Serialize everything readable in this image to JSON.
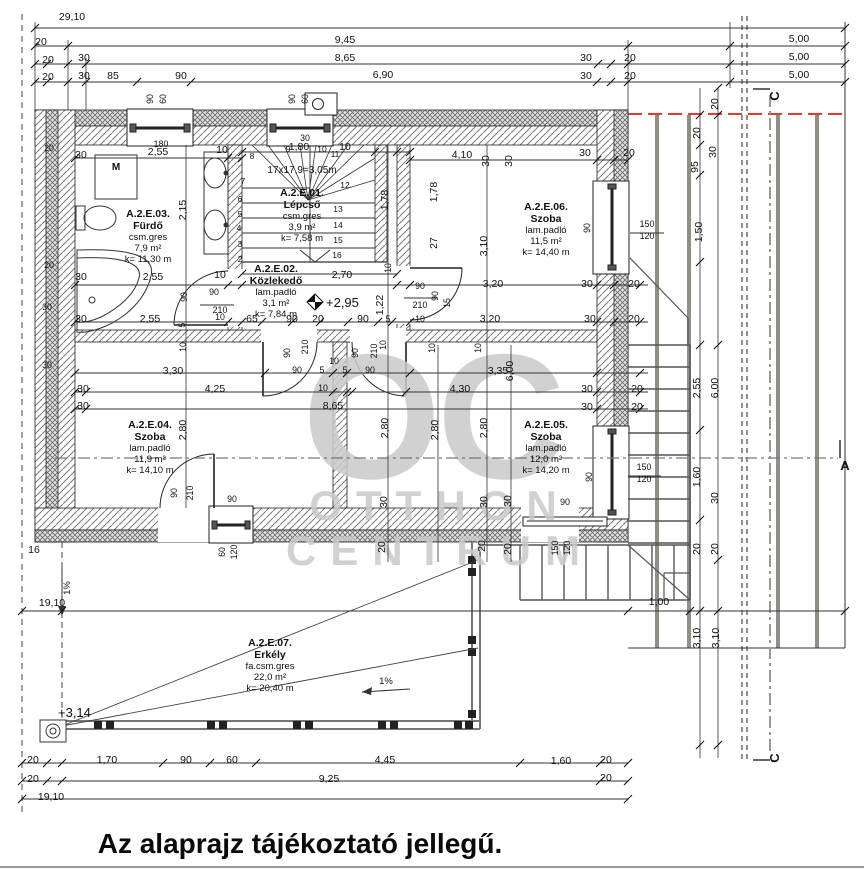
{
  "title": "Az alaprajz tájékoztató jellegű.",
  "watermark": {
    "line1": "OC",
    "line2": "OTTHON",
    "line3": "CENTRUM"
  },
  "stair": {
    "note": "17x17,9=3,05m",
    "x": 302,
    "y": 173
  },
  "rooms": [
    {
      "id": "A.2.E.03.",
      "name": "Fürdő",
      "floor": "csm.gres",
      "area": "7,9 m²",
      "k": "k= 11,30 m",
      "cx": 148,
      "y0": 217
    },
    {
      "id": "A.2.E.01.",
      "name": "Lépcső",
      "floor": "csm.gres",
      "area": "3,9 m²",
      "k": "k= 7,58 m",
      "cx": 302,
      "y0": 196
    },
    {
      "id": "A.2.E.02.",
      "name": "Közlekedő",
      "floor": "lam.padló",
      "area": "3,1 m²",
      "k": "k= 7,84 m",
      "cx": 276,
      "y0": 272
    },
    {
      "id": "A.2.E.06.",
      "name": "Szoba",
      "floor": "lam.padló",
      "area": "11,5 m²",
      "k": "k= 14,40 m",
      "cx": 546,
      "y0": 210
    },
    {
      "id": "A.2.E.04.",
      "name": "Szoba",
      "floor": "lam.padló",
      "area": "11,9 m²",
      "k": "k= 14,10 m",
      "cx": 150,
      "y0": 428
    },
    {
      "id": "A.2.E.05.",
      "name": "Szoba",
      "floor": "lam.padló",
      "area": "12,0 m²",
      "k": "k= 14,20 m",
      "cx": 546,
      "y0": 428
    },
    {
      "id": "A.2.E.07.",
      "name": "Erkély",
      "floor": "fa.csm.gres",
      "area": "22,0 m²",
      "k": "k= 20,40 m",
      "cx": 270,
      "y0": 646
    }
  ],
  "labels": {
    "sections": [
      {
        "t": "C",
        "x": 779,
        "y": 96,
        "r": 1
      },
      {
        "t": "A",
        "x": 845,
        "y": 470
      },
      {
        "t": "C",
        "x": 779,
        "y": 758,
        "r": 1
      }
    ],
    "levels": [
      {
        "t": "+2,95",
        "x": 326,
        "y": 307
      },
      {
        "t": "+3,14",
        "x": 58,
        "y": 717
      }
    ],
    "slopes": [
      {
        "t": "1%",
        "x": 386,
        "y": 684
      },
      {
        "t": "1%",
        "x": 70,
        "y": 588,
        "r": 1
      }
    ],
    "fixtures": [
      {
        "t": "M",
        "x": 116,
        "y": 170
      }
    ],
    "steps": [
      {
        "t": "2",
        "x": 240,
        "y": 262
      },
      {
        "t": "3",
        "x": 240,
        "y": 247
      },
      {
        "t": "4",
        "x": 239,
        "y": 231
      },
      {
        "t": "5",
        "x": 240,
        "y": 217
      },
      {
        "t": "6",
        "x": 240,
        "y": 202
      },
      {
        "t": "7",
        "x": 243,
        "y": 184
      },
      {
        "t": "8",
        "x": 252,
        "y": 159
      },
      {
        "t": "9",
        "x": 288,
        "y": 152
      },
      {
        "t": "10",
        "x": 322,
        "y": 152
      },
      {
        "t": "11",
        "x": 335,
        "y": 157
      },
      {
        "t": "12",
        "x": 345,
        "y": 188
      },
      {
        "t": "13",
        "x": 338,
        "y": 212
      },
      {
        "t": "14",
        "x": 338,
        "y": 228
      },
      {
        "t": "15",
        "x": 338,
        "y": 243
      },
      {
        "t": "16",
        "x": 337,
        "y": 258
      }
    ],
    "dims": [
      {
        "t": "29,10",
        "x": 72,
        "y": 20
      },
      {
        "t": "20",
        "x": 41,
        "y": 45
      },
      {
        "t": "9,45",
        "x": 345,
        "y": 43
      },
      {
        "t": "5,00",
        "x": 799,
        "y": 42
      },
      {
        "t": "20",
        "x": 48,
        "y": 63
      },
      {
        "t": "30",
        "x": 84,
        "y": 61
      },
      {
        "t": "8,65",
        "x": 345,
        "y": 61
      },
      {
        "t": "30",
        "x": 586,
        "y": 61
      },
      {
        "t": "20",
        "x": 630,
        "y": 61
      },
      {
        "t": "5,00",
        "x": 799,
        "y": 60
      },
      {
        "t": "20",
        "x": 48,
        "y": 80
      },
      {
        "t": "30",
        "x": 84,
        "y": 79
      },
      {
        "t": "85",
        "x": 113,
        "y": 79
      },
      {
        "t": "90",
        "x": 181,
        "y": 79
      },
      {
        "t": "6,90",
        "x": 383,
        "y": 78
      },
      {
        "t": "30",
        "x": 586,
        "y": 79
      },
      {
        "t": "20",
        "x": 630,
        "y": 79
      },
      {
        "t": "5,00",
        "x": 799,
        "y": 78
      },
      {
        "t": "90",
        "x": 153,
        "y": 99,
        "r": 1,
        "s": 1
      },
      {
        "t": "60",
        "x": 166,
        "y": 99,
        "r": 1,
        "s": 1
      },
      {
        "t": "90",
        "x": 295,
        "y": 99,
        "r": 1,
        "s": 1
      },
      {
        "t": "60",
        "x": 308,
        "y": 99,
        "r": 1,
        "s": 1
      },
      {
        "t": "180",
        "x": 161,
        "y": 147,
        "s": 1
      },
      {
        "t": "30",
        "x": 81,
        "y": 158
      },
      {
        "t": "2,55",
        "x": 158,
        "y": 155
      },
      {
        "t": "10",
        "x": 222,
        "y": 153
      },
      {
        "t": "1,80",
        "x": 299,
        "y": 150
      },
      {
        "t": "30",
        "x": 305,
        "y": 141,
        "s": 1
      },
      {
        "t": "10",
        "x": 345,
        "y": 150
      },
      {
        "t": "4,10",
        "x": 462,
        "y": 158
      },
      {
        "t": "30",
        "x": 489,
        "y": 161,
        "r": 1
      },
      {
        "t": "30",
        "x": 512,
        "y": 161,
        "r": 1
      },
      {
        "t": "30",
        "x": 585,
        "y": 156
      },
      {
        "t": "20",
        "x": 629,
        "y": 156
      },
      {
        "t": "20",
        "x": 718,
        "y": 104,
        "r": 1
      },
      {
        "t": "20",
        "x": 700,
        "y": 133,
        "r": 1
      },
      {
        "t": "95",
        "x": 698,
        "y": 167,
        "r": 1
      },
      {
        "t": "30",
        "x": 716,
        "y": 152,
        "r": 1
      },
      {
        "t": "1,50",
        "x": 702,
        "y": 232,
        "r": 1
      },
      {
        "t": "150",
        "x": 647,
        "y": 227,
        "s": 1
      },
      {
        "t": "120",
        "x": 647,
        "y": 239,
        "s": 1
      },
      {
        "t": "90",
        "x": 590,
        "y": 228,
        "r": 1,
        "s": 1
      },
      {
        "t": "2,15",
        "x": 186,
        "y": 210,
        "r": 1
      },
      {
        "t": "1,78",
        "x": 388,
        "y": 200,
        "r": 1
      },
      {
        "t": "1,78",
        "x": 437,
        "y": 192,
        "r": 1
      },
      {
        "t": "27",
        "x": 437,
        "y": 243,
        "r": 1
      },
      {
        "t": "3,10",
        "x": 487,
        "y": 246,
        "r": 1
      },
      {
        "t": "2,70",
        "x": 342,
        "y": 278
      },
      {
        "t": "10",
        "x": 391,
        "y": 268,
        "r": 1,
        "s": 1
      },
      {
        "t": "90",
        "x": 420,
        "y": 289,
        "s": 1
      },
      {
        "t": "210",
        "x": 420,
        "y": 308,
        "s": 1
      },
      {
        "t": "90",
        "x": 438,
        "y": 296,
        "r": 1,
        "s": 1
      },
      {
        "t": "15",
        "x": 450,
        "y": 303,
        "r": 1,
        "s": 1
      },
      {
        "t": "10",
        "x": 420,
        "y": 322,
        "s": 1
      },
      {
        "t": "1,22",
        "x": 383,
        "y": 305,
        "r": 1
      },
      {
        "t": "30",
        "x": 81,
        "y": 280
      },
      {
        "t": "2,55",
        "x": 153,
        "y": 280
      },
      {
        "t": "10",
        "x": 220,
        "y": 278
      },
      {
        "t": "90",
        "x": 187,
        "y": 297,
        "r": 1,
        "s": 1
      },
      {
        "t": "90",
        "x": 214,
        "y": 295,
        "s": 1
      },
      {
        "t": "210",
        "x": 220,
        "y": 313,
        "s": 1
      },
      {
        "t": "5",
        "x": 185,
        "y": 325,
        "r": 1,
        "s": 1
      },
      {
        "t": "30",
        "x": 81,
        "y": 322
      },
      {
        "t": "2,55",
        "x": 150,
        "y": 322
      },
      {
        "t": "10",
        "x": 220,
        "y": 320,
        "s": 1
      },
      {
        "t": "65",
        "x": 252,
        "y": 322
      },
      {
        "t": "90",
        "x": 292,
        "y": 322
      },
      {
        "t": "20",
        "x": 318,
        "y": 322
      },
      {
        "t": "90",
        "x": 363,
        "y": 322
      },
      {
        "t": "5",
        "x": 388,
        "y": 322,
        "s": 1
      },
      {
        "t": "3,20",
        "x": 493,
        "y": 287
      },
      {
        "t": "30",
        "x": 587,
        "y": 287
      },
      {
        "t": "20",
        "x": 634,
        "y": 287
      },
      {
        "t": "3,20",
        "x": 490,
        "y": 322
      },
      {
        "t": "30",
        "x": 590,
        "y": 322
      },
      {
        "t": "20",
        "x": 634,
        "y": 322
      },
      {
        "t": "6,00",
        "x": 513,
        "y": 371,
        "r": 1
      },
      {
        "t": "10",
        "x": 186,
        "y": 347,
        "r": 1,
        "s": 1
      },
      {
        "t": "3,30",
        "x": 173,
        "y": 374
      },
      {
        "t": "30",
        "x": 83,
        "y": 392
      },
      {
        "t": "4,25",
        "x": 215,
        "y": 392
      },
      {
        "t": "30",
        "x": 83,
        "y": 409
      },
      {
        "t": "8,65",
        "x": 333,
        "y": 409
      },
      {
        "t": "90",
        "x": 290,
        "y": 353,
        "r": 1,
        "s": 1
      },
      {
        "t": "210",
        "x": 308,
        "y": 347,
        "r": 1,
        "s": 1
      },
      {
        "t": "10",
        "x": 334,
        "y": 364,
        "s": 1
      },
      {
        "t": "90",
        "x": 358,
        "y": 353,
        "r": 1,
        "s": 1
      },
      {
        "t": "210",
        "x": 377,
        "y": 351,
        "r": 1,
        "s": 1
      },
      {
        "t": "10",
        "x": 386,
        "y": 345,
        "r": 1,
        "s": 1
      },
      {
        "t": "90",
        "x": 297,
        "y": 373,
        "s": 1
      },
      {
        "t": "5",
        "x": 322,
        "y": 373,
        "s": 1
      },
      {
        "t": "5",
        "x": 345,
        "y": 373,
        "s": 1
      },
      {
        "t": "90",
        "x": 370,
        "y": 373,
        "s": 1
      },
      {
        "t": "10",
        "x": 323,
        "y": 391,
        "s": 1
      },
      {
        "t": "10",
        "x": 435,
        "y": 348,
        "r": 1,
        "s": 1
      },
      {
        "t": "10",
        "x": 481,
        "y": 348,
        "r": 1,
        "s": 1
      },
      {
        "t": "3,35",
        "x": 498,
        "y": 374
      },
      {
        "t": "4,30",
        "x": 460,
        "y": 392
      },
      {
        "t": "30",
        "x": 587,
        "y": 392
      },
      {
        "t": "20",
        "x": 637,
        "y": 392
      },
      {
        "t": "30",
        "x": 587,
        "y": 410
      },
      {
        "t": "20",
        "x": 637,
        "y": 410
      },
      {
        "t": "2,80",
        "x": 186,
        "y": 430,
        "r": 1
      },
      {
        "t": "2,80",
        "x": 388,
        "y": 428,
        "r": 1
      },
      {
        "t": "2,80",
        "x": 438,
        "y": 430,
        "r": 1
      },
      {
        "t": "2,80",
        "x": 487,
        "y": 428,
        "r": 1
      },
      {
        "t": "2,55",
        "x": 700,
        "y": 388,
        "r": 1
      },
      {
        "t": "6,00",
        "x": 718,
        "y": 388,
        "r": 1
      },
      {
        "t": "90",
        "x": 177,
        "y": 493,
        "r": 1,
        "s": 1
      },
      {
        "t": "210",
        "x": 193,
        "y": 493,
        "r": 1,
        "s": 1
      },
      {
        "t": "90",
        "x": 232,
        "y": 502,
        "s": 1
      },
      {
        "t": "90",
        "x": 592,
        "y": 477,
        "r": 1,
        "s": 1
      },
      {
        "t": "150",
        "x": 644,
        "y": 470,
        "s": 1
      },
      {
        "t": "120",
        "x": 644,
        "y": 482,
        "s": 1
      },
      {
        "t": "1,60",
        "x": 700,
        "y": 477,
        "r": 1
      },
      {
        "t": "30",
        "x": 718,
        "y": 498,
        "r": 1
      },
      {
        "t": "30",
        "x": 387,
        "y": 502,
        "r": 1
      },
      {
        "t": "30",
        "x": 487,
        "y": 502,
        "r": 1
      },
      {
        "t": "30",
        "x": 511,
        "y": 501,
        "r": 1
      },
      {
        "t": "90",
        "x": 565,
        "y": 505,
        "s": 1
      },
      {
        "t": "20",
        "x": 385,
        "y": 547,
        "r": 1
      },
      {
        "t": "20",
        "x": 485,
        "y": 546,
        "r": 1
      },
      {
        "t": "20",
        "x": 511,
        "y": 549,
        "r": 1
      },
      {
        "t": "150",
        "x": 558,
        "y": 548,
        "r": 1,
        "s": 1
      },
      {
        "t": "120",
        "x": 570,
        "y": 548,
        "r": 1,
        "s": 1
      },
      {
        "t": "20",
        "x": 700,
        "y": 549,
        "r": 1
      },
      {
        "t": "20",
        "x": 718,
        "y": 549,
        "r": 1
      },
      {
        "t": "60",
        "x": 225,
        "y": 552,
        "r": 1,
        "s": 1
      },
      {
        "t": "120",
        "x": 237,
        "y": 552,
        "r": 1,
        "s": 1
      },
      {
        "t": "16",
        "x": 34,
        "y": 553
      },
      {
        "t": "19,10",
        "x": 52,
        "y": 606
      },
      {
        "t": "1,00",
        "x": 659,
        "y": 605
      },
      {
        "t": "3,10",
        "x": 700,
        "y": 638,
        "r": 1
      },
      {
        "t": "3,10",
        "x": 719,
        "y": 638,
        "r": 1
      },
      {
        "t": "20",
        "x": 33,
        "y": 763
      },
      {
        "t": "1,70",
        "x": 107,
        "y": 763
      },
      {
        "t": "90",
        "x": 186,
        "y": 763
      },
      {
        "t": "60",
        "x": 232,
        "y": 763
      },
      {
        "t": "4,45",
        "x": 385,
        "y": 763
      },
      {
        "t": "1,60",
        "x": 561,
        "y": 764
      },
      {
        "t": "20",
        "x": 606,
        "y": 763
      },
      {
        "t": "20",
        "x": 33,
        "y": 782
      },
      {
        "t": "9,25",
        "x": 329,
        "y": 782
      },
      {
        "t": "20",
        "x": 606,
        "y": 781
      },
      {
        "t": "19,10",
        "x": 51,
        "y": 800
      },
      {
        "t": "20",
        "x": 49,
        "y": 151,
        "s": 1
      },
      {
        "t": "20",
        "x": 49,
        "y": 268,
        "s": 1
      },
      {
        "t": "30",
        "x": 47,
        "y": 310,
        "s": 1
      },
      {
        "t": "30",
        "x": 47,
        "y": 368,
        "s": 1
      }
    ]
  }
}
